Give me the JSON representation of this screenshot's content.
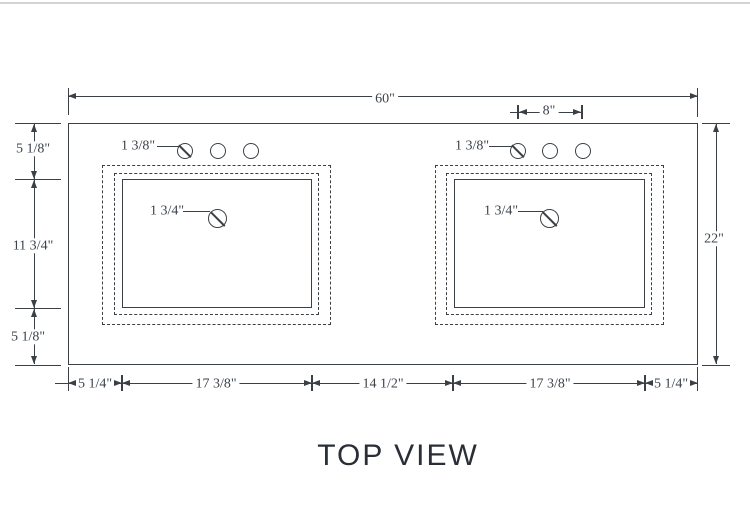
{
  "title": "TOP VIEW",
  "colors": {
    "line": "#3b4046",
    "dim_text": "#3b434d",
    "title_text": "#2a2e37"
  },
  "dimensions": {
    "top_width": "60\"",
    "faucet_span": "8\"",
    "depth": "22\"",
    "left_chain": [
      "5 1/8\"",
      "11 3/4\"",
      "5 1/8\""
    ],
    "bottom_chain": [
      "5 1/4\"",
      "17 3/8\"",
      "14 1/2\"",
      "17 3/8\"",
      "5 1/4\""
    ],
    "left_sink": {
      "faucet_hole_diameter": "1 3/8\"",
      "drain_hole_diameter": "1 3/4\""
    },
    "right_sink": {
      "faucet_hole_diameter": "1 3/8\"",
      "drain_hole_diameter": "1 3/4\""
    }
  }
}
